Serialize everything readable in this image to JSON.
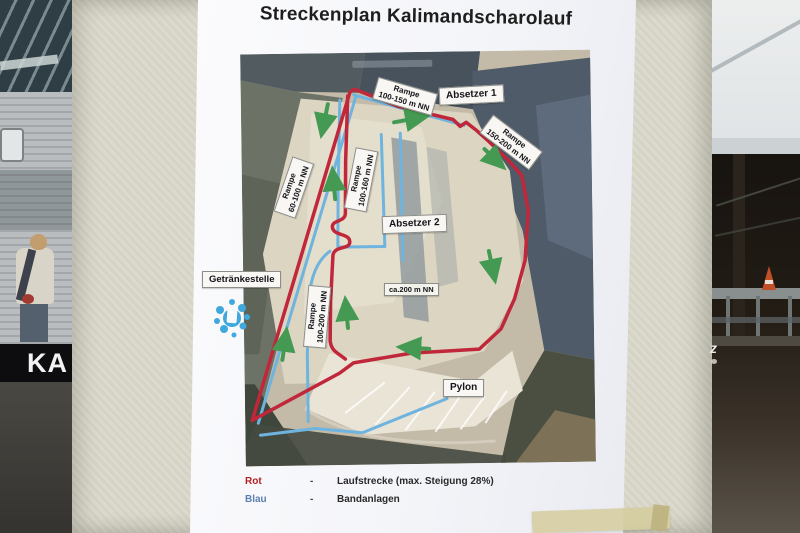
{
  "poster": {
    "title": "Streckenplan Kalimandscharolauf",
    "map_labels": {
      "rampe_top": {
        "line1": "Rampe",
        "line2": "100-150 m NN"
      },
      "absetzer1": "Absetzer 1",
      "rampe_right": {
        "line1": "Rampe",
        "line2": "150-200 m NN"
      },
      "rampe_left": {
        "line1": "Rampe",
        "line2": "60-100 m NN"
      },
      "rampe_mid": {
        "line1": "Rampe",
        "line2": "100-160 m NN"
      },
      "absetzer2": "Absetzer 2",
      "drink_station": "Getränkestelle",
      "plateau": "ca.200 m NN",
      "rampe_lower": {
        "line1": "Rampe",
        "line2": "100-200 m NN"
      },
      "pylon": "Pylon"
    },
    "legend": {
      "rows": [
        {
          "term": "Rot",
          "separator": "-",
          "description": "Laufstrecke (max. Steigung 28%)"
        },
        {
          "term": "Blau",
          "separator": "-",
          "description": "Bandanlagen"
        }
      ]
    },
    "colors": {
      "route_red": "#c1273a",
      "conveyor_blue": "#6fb4de",
      "arrow_green": "#449a52",
      "legend_rot": "#b32025",
      "legend_blau": "#5b7fae"
    }
  },
  "background": {
    "banner_text": "KA",
    "partial_sign_text": "z"
  }
}
